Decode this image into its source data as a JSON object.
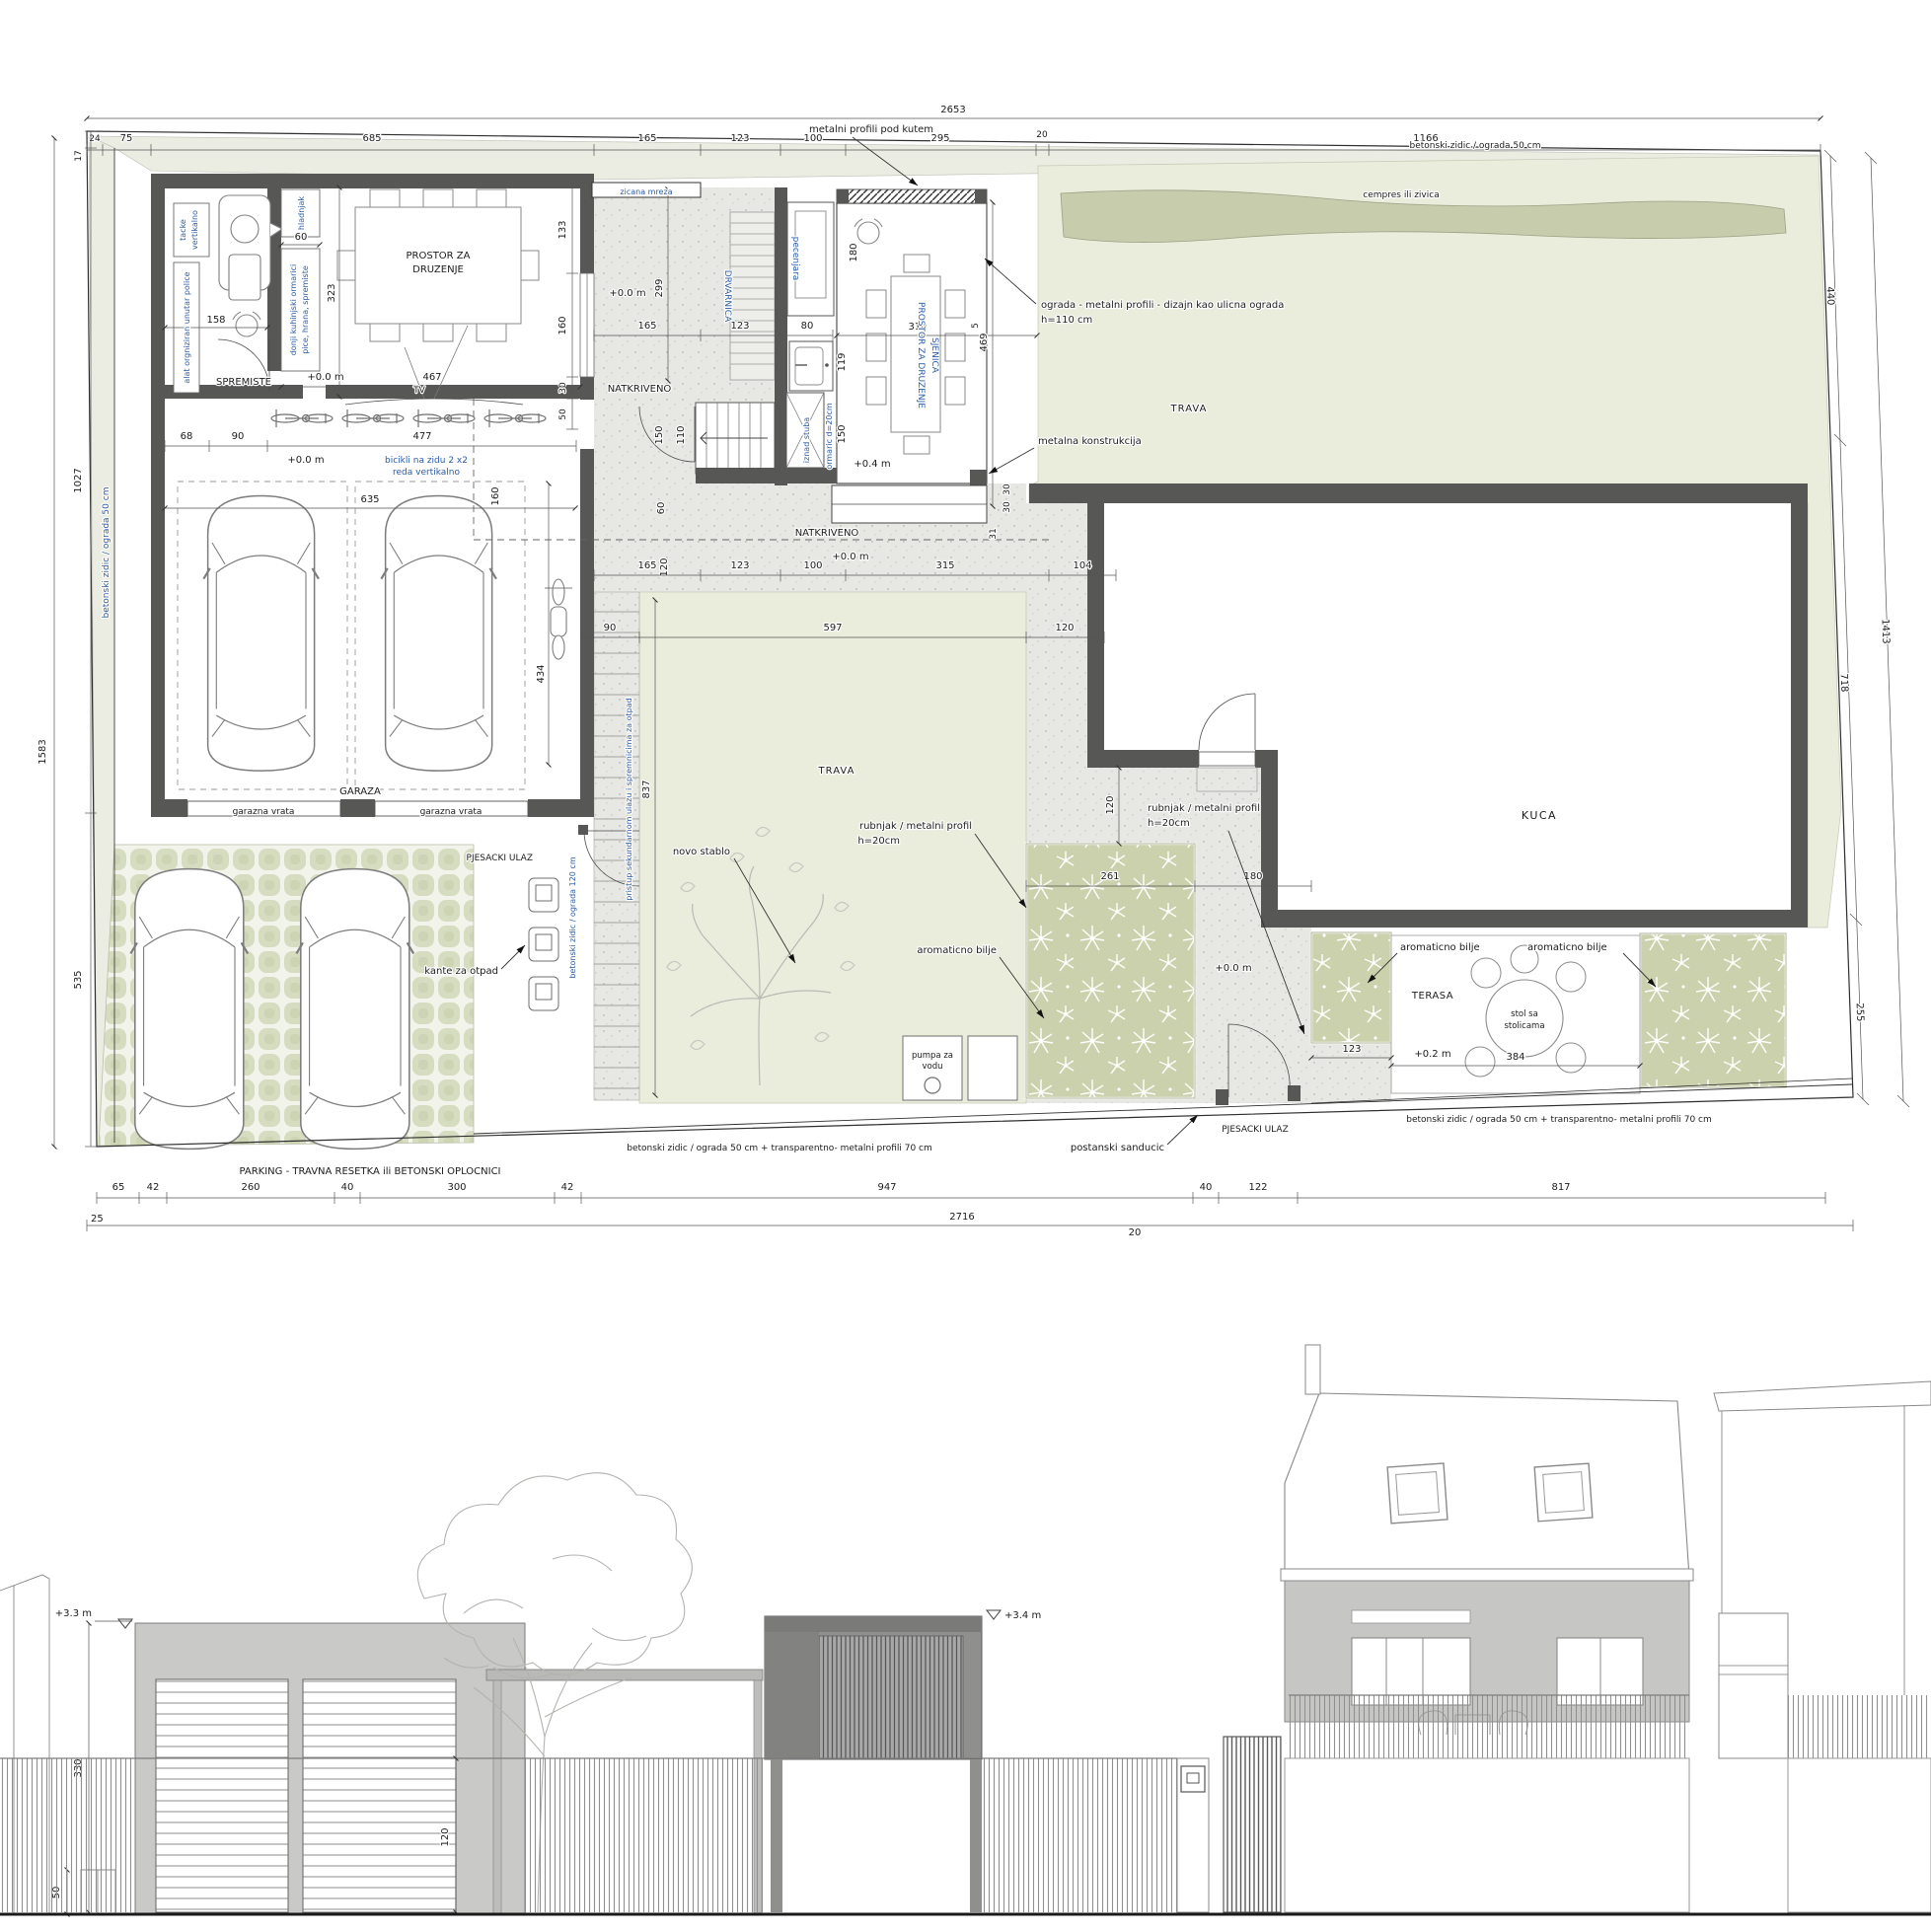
{
  "plan": {
    "dims": {
      "top_total": "2653",
      "top": [
        "24",
        "75",
        "685",
        "165",
        "123",
        "100",
        "295",
        "20",
        "1166"
      ],
      "left_total": "1583",
      "left": [
        "17",
        "1027",
        "535"
      ],
      "right_inner": [
        "440",
        "718",
        "255"
      ],
      "right_outer_total": "1413",
      "bottom": [
        "65",
        "42",
        "260",
        "40",
        "300",
        "42",
        "947",
        "40",
        "122",
        "817"
      ],
      "bottom_total": "2716",
      "b25": "25",
      "b20": "20",
      "d60a": "60",
      "d323": "323",
      "d133": "133",
      "d158": "158",
      "d467": "467",
      "d160a": "160",
      "d30a": "30",
      "d50a": "50",
      "d68": "68",
      "d90a": "90",
      "d477": "477",
      "d635": "635",
      "d434": "434",
      "d160b": "160",
      "d299": "299",
      "d165a": "165",
      "d123a": "123",
      "d80": "80",
      "d119": "119",
      "d150a": "150",
      "d110": "110",
      "d150b": "150",
      "d180": "180",
      "d310": "310",
      "d469": "469",
      "d5": "5",
      "d60b": "60",
      "d120a": "120",
      "d165b": "165",
      "d123b": "123",
      "d100": "100",
      "d315": "315",
      "d104": "104",
      "d31": "31",
      "d30b": "30",
      "d30c": "30",
      "d90b": "90",
      "d597": "597",
      "d120b": "120",
      "d837": "837",
      "d120c": "120",
      "d261": "261",
      "d180b": "180",
      "d123c": "123",
      "d384": "384"
    },
    "levels": {
      "l0": "+0.0 m",
      "l04": "+0.4 m",
      "l02": "+0.2 m"
    },
    "labels": {
      "metalni_profili": "metalni profili pod kutem",
      "betonski50": "betonski zidic / ograda 50 cm",
      "cempres": "cempres ili zivica",
      "ograda_l1": "ograda - metalni profili - dizajn kao ulicna ograda",
      "ograda_l2": "h=110 cm",
      "metalna_konstrukcija": "metalna konstrukcija",
      "trava": "TRAVA",
      "kuca": "KUCA",
      "zicana": "zicana mreza",
      "drvarnica": "DRVARNICA",
      "pecenjara": "pecenjara",
      "prostor_l1": "PROSTOR ZA",
      "prostor_l2": "DRUZENJE",
      "sjenica_l1": "PROSTOR ZA DRUZENJE",
      "sjenica_l2": "SJENICA",
      "natkriveno": "NATKRIVENO",
      "spremiste": "SPREMISTE",
      "garaza": "GARAZA",
      "garazna_vrata": "garazna vrata",
      "tacke_l1": "tacke",
      "tacke_l2": "vertikalno",
      "hladnjak": "hladnjak",
      "alat": "alat orgniziran unutar police",
      "donji_l1": "donji kuhinjski ormarici",
      "donji_l2": "pice, hrana, spremiste",
      "bicikli_l1": "bicikli na zidu 2 x2",
      "bicikli_l2": "reda vertikalno",
      "tv": "TV",
      "iznad": "iznad stuba",
      "ormaric": "ormaric d=20cm",
      "betonski120": "betonski zidic / ograda 120 cm",
      "pristup": "pristup sekundarnom ulazu i spremnicima za otpad",
      "pjesacki": "PJESACKI ULAZ",
      "kante": "kante za otpad",
      "novo": "novo stablo",
      "rubnjak_l1": "rubnjak / metalni profil",
      "rubnjak_l2": "h=20cm",
      "aromaticno": "aromaticno bilje",
      "pumpa_l1": "pumpa za",
      "pumpa_l2": "vodu",
      "postanski": "postanski sanducic",
      "stol_l1": "stol sa",
      "stol_l2": "stolicama",
      "terasa": "TERASA",
      "parking": "PARKING - TRAVNA RESETKA ili BETONSKI OPLOCNICI",
      "fence70": "betonski zidic / ograda 50 cm + transparentno- metalni profili 70 cm"
    }
  },
  "elevation": {
    "levels": {
      "l33": "+3.3 m",
      "l34": "+3.4 m"
    },
    "dims": {
      "d330": "330",
      "d50": "50",
      "d120": "120"
    }
  }
}
